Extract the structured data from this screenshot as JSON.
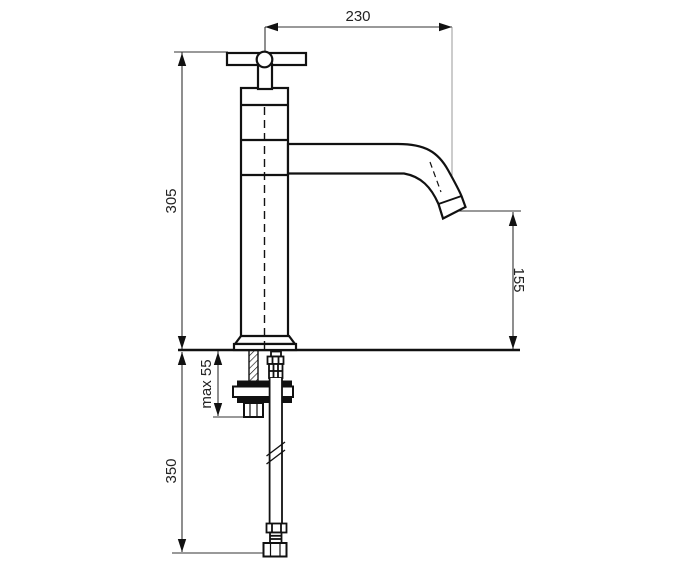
{
  "drawing": {
    "kind": "technical-dimension-drawing",
    "subject": "pillar basin tap with cross handle, side view with under-counter mounting hardware and supply hose"
  },
  "dimensions": {
    "spout_reach": "230",
    "total_height": "305",
    "outlet_height": "155",
    "deck_thickness": "max 55",
    "hose_length": "350"
  },
  "colors": {
    "background": "#ffffff",
    "outline": "#111111",
    "dimension_line": "#333333",
    "reference_line": "#999999",
    "text": "#222222"
  }
}
